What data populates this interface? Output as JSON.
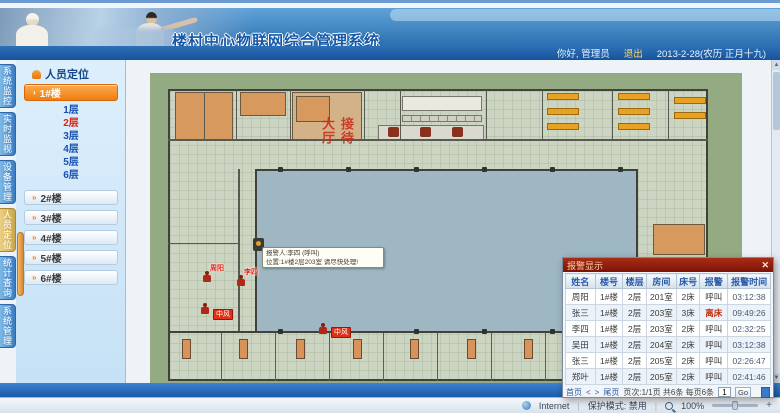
{
  "header": {
    "title": "楼村中心物联网综合管理系统",
    "greeting": "你好, 管理员",
    "logout": "退出",
    "date": "2013-2-28(农历 正月十九)"
  },
  "nav_tabs": [
    {
      "label": "系统监控",
      "active": false
    },
    {
      "label": "实时监视",
      "active": false
    },
    {
      "label": "设备管理",
      "active": false
    },
    {
      "label": "人员定位",
      "active": true
    },
    {
      "label": "统计查询",
      "active": false
    },
    {
      "label": "系统管理",
      "active": false
    }
  ],
  "sidebar": {
    "header": "人员定位",
    "selected_building": "1#楼",
    "floors": [
      {
        "label": "1层",
        "active": false
      },
      {
        "label": "2层",
        "active": true
      },
      {
        "label": "3层",
        "active": false
      },
      {
        "label": "4层",
        "active": false
      },
      {
        "label": "5层",
        "active": false
      },
      {
        "label": "6层",
        "active": false
      }
    ],
    "buildings": [
      "2#楼",
      "3#楼",
      "4#楼",
      "5#楼",
      "6#楼"
    ]
  },
  "floorplan": {
    "hall_label": "接待大厅",
    "tooltip": {
      "line1": "报警人:李四 (呼叫)",
      "line2": "位置:1#楼2层203室 请尽快处理!"
    },
    "markers": [
      {
        "x": 52,
        "y": 198,
        "label": "周阳",
        "type": "person"
      },
      {
        "x": 86,
        "y": 202,
        "label": "李四",
        "type": "person"
      },
      {
        "x": 50,
        "y": 230,
        "label": "",
        "type": "person"
      },
      {
        "x": 63,
        "y": 236,
        "label": "中风",
        "type": "alert"
      },
      {
        "x": 168,
        "y": 250,
        "label": "",
        "type": "person"
      },
      {
        "x": 181,
        "y": 254,
        "label": "中风",
        "type": "alert"
      }
    ]
  },
  "alarm_popup": {
    "title": "报警显示",
    "close": "✕",
    "columns": [
      "姓名",
      "楼号",
      "楼层",
      "房间",
      "床号",
      "报警",
      "报警时间"
    ],
    "rows": [
      [
        "周阳",
        "1#楼",
        "2层",
        "201室",
        "2床",
        "呼叫",
        "03:12:38"
      ],
      [
        "张三",
        "1#楼",
        "2层",
        "203室",
        "3床",
        "离床",
        "09:49:26"
      ],
      [
        "李四",
        "1#楼",
        "2层",
        "203室",
        "2床",
        "呼叫",
        "02:32:25"
      ],
      [
        "吴田",
        "1#楼",
        "2层",
        "204室",
        "2床",
        "呼叫",
        "03:12:38"
      ],
      [
        "张三",
        "1#楼",
        "2层",
        "205室",
        "2床",
        "呼叫",
        "02:26:47"
      ],
      [
        "郑叶",
        "1#楼",
        "2层",
        "205室",
        "2床",
        "呼叫",
        "02:41:46"
      ]
    ],
    "pagination": {
      "first": "首页",
      "prev": "<",
      "next": ">",
      "last": "尾页",
      "info": "页次:1/1页 共6条 每页6条",
      "page_value": "1",
      "go": "Go"
    }
  },
  "statusbar": {
    "internet": "Internet",
    "protected_mode": "保护模式: 禁用",
    "zoom": "100%"
  },
  "colors": {
    "accent_orange": "#ef7d12",
    "alarm_red": "#e03018",
    "header_blue": "#2e6fb0",
    "popup_title_red": "#8a1c0e",
    "courtyard_blue": "#9eb7c2",
    "plan_green": "#94aa82"
  }
}
